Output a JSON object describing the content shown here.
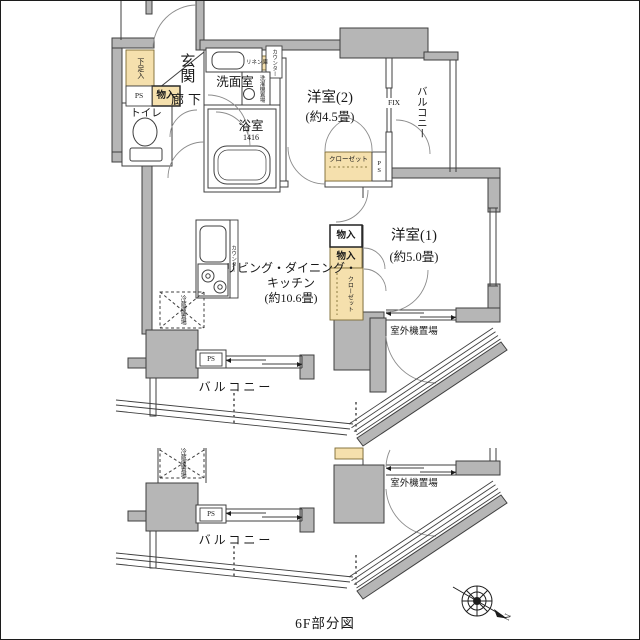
{
  "plan": {
    "caption": "6F部分図",
    "compass_north": "N",
    "rooms": {
      "genkan": "玄関",
      "corridor": "廊下",
      "toilet": "トイレ",
      "washroom": "洗面室",
      "bathroom": "浴室",
      "bathroom_size": "1416",
      "western2_name": "洋室(2)",
      "western2_size": "(約4.5畳)",
      "western1_name": "洋室(1)",
      "western1_size": "(約5.0畳)",
      "ldk_line1": "リビング・ダイニング・",
      "ldk_line2": "キッチン",
      "ldk_size": "(約10.6畳)",
      "balcony": "バルコニー",
      "outdoor_unit": "室外機置場"
    },
    "storage": {
      "shoe_box": "下足入",
      "mono_iri": "物入",
      "linen": "リネン庫",
      "closet": "クローゼット",
      "counter": "カウンター",
      "washer": "洗濯機置場",
      "fridge": "冷蔵庫置場",
      "ps": "PS",
      "fix": "FIX"
    },
    "colors": {
      "wall_gray": "#b6b6b6",
      "storage_tan": "#f5e0ad",
      "line": "#3f3f3f"
    }
  }
}
